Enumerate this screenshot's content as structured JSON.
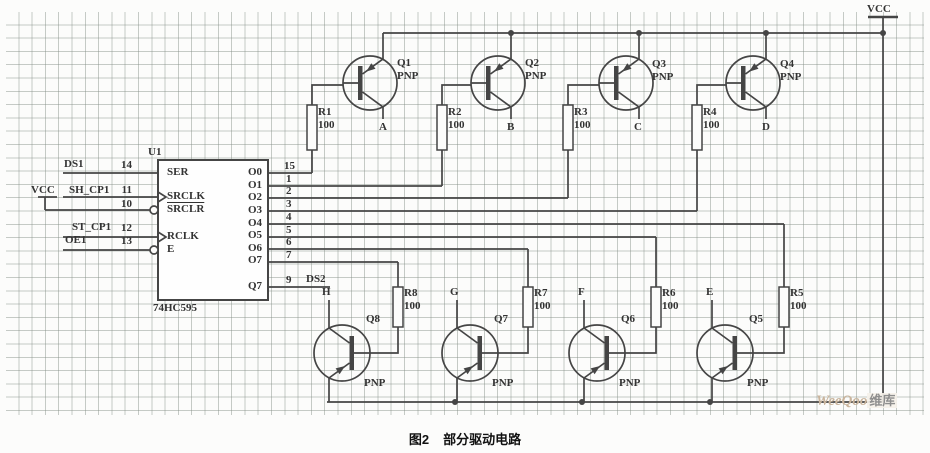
{
  "caption": {
    "fig": "图2",
    "text": "部分驱动电路"
  },
  "watermark": {
    "brand": "WeeQoo",
    "suffix": "维库"
  },
  "colors": {
    "wire": "#454545",
    "paper": "#fcfcfb",
    "grid": "#828c84"
  },
  "power": {
    "vcc_top": "VCC",
    "vcc_left": "VCC"
  },
  "ic": {
    "ref": "U1",
    "part": "74HC595",
    "pins_left": [
      {
        "name": "SER",
        "num": "14",
        "net": "DS1"
      },
      {
        "name": "SRCLK",
        "num": "11",
        "net": "SH_CP1"
      },
      {
        "name": "SRCLR",
        "num": "10",
        "net": ""
      },
      {
        "name": "RCLK",
        "num": "12",
        "net": "ST_CP1"
      },
      {
        "name": "E",
        "num": "13",
        "net": "OE1"
      }
    ],
    "pins_right": [
      {
        "name": "O0",
        "num": "15"
      },
      {
        "name": "O1",
        "num": "1"
      },
      {
        "name": "O2",
        "num": "2"
      },
      {
        "name": "O3",
        "num": "3"
      },
      {
        "name": "O4",
        "num": "4"
      },
      {
        "name": "O5",
        "num": "5"
      },
      {
        "name": "O6",
        "num": "6"
      },
      {
        "name": "O7",
        "num": "7"
      },
      {
        "name": "Q7",
        "num": "9",
        "net": "DS2"
      }
    ]
  },
  "top_row": [
    {
      "q": "Q1",
      "type": "PNP",
      "r": "R1",
      "val": "100",
      "net": "A"
    },
    {
      "q": "Q2",
      "type": "PNP",
      "r": "R2",
      "val": "100",
      "net": "B"
    },
    {
      "q": "Q3",
      "type": "PNP",
      "r": "R3",
      "val": "100",
      "net": "C"
    },
    {
      "q": "Q4",
      "type": "PNP",
      "r": "R4",
      "val": "100",
      "net": "D"
    }
  ],
  "bottom_row": [
    {
      "q": "Q8",
      "type": "PNP",
      "r": "R8",
      "val": "100",
      "net": "H"
    },
    {
      "q": "Q7",
      "type": "PNP",
      "r": "R7",
      "val": "100",
      "net": "G"
    },
    {
      "q": "Q6",
      "type": "PNP",
      "r": "R6",
      "val": "100",
      "net": "F"
    },
    {
      "q": "Q5",
      "type": "PNP",
      "r": "R5",
      "val": "100",
      "net": "E"
    }
  ]
}
